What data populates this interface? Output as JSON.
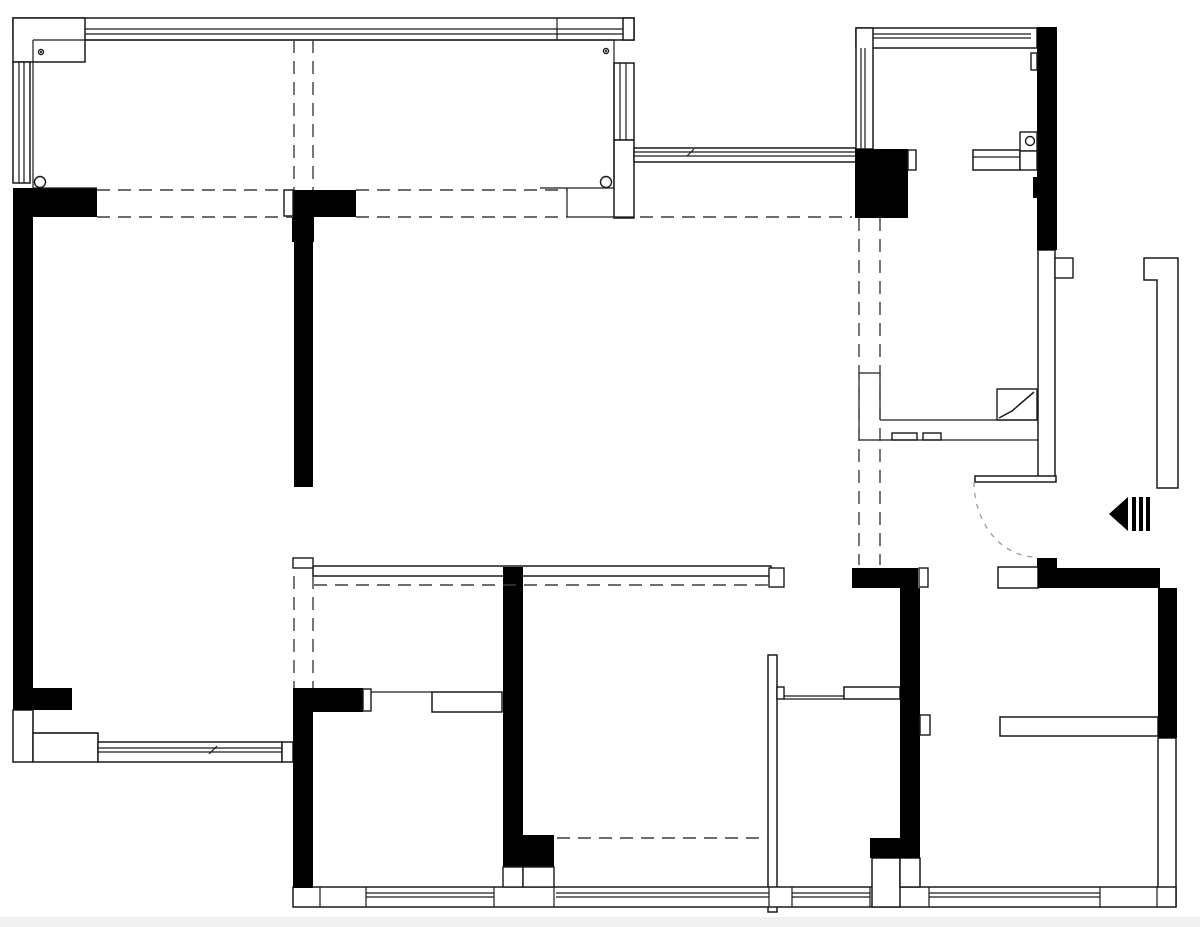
{
  "meta": {
    "drawing_kind": "apartment-floor-plan",
    "canvas": {
      "width": 1200,
      "height": 927
    },
    "colors": {
      "wall_fill": "#000000",
      "line": "#1a1a1a",
      "outline_fill": "#ffffff",
      "dash": "#3d3d3d",
      "arc_dash": "#9a9a9a",
      "background": "#ffffff",
      "footer_strip": "#f3f1f0"
    }
  },
  "plan": {
    "outline_rects": [
      {
        "name": "balcony-top-wall-band",
        "x": 13,
        "y": 18,
        "w": 621,
        "h": 22
      },
      {
        "name": "balcony-top-left-corner-box",
        "x": 13,
        "y": 18,
        "w": 72,
        "h": 44
      },
      {
        "name": "balcony-top-right-corner-box",
        "x": 623,
        "y": 18,
        "w": 11,
        "h": 22
      },
      {
        "name": "balcony-left-window",
        "x": 13,
        "y": 62,
        "w": 17,
        "h": 121
      },
      {
        "name": "balcony-right-window",
        "x": 614,
        "y": 63,
        "w": 20,
        "h": 77
      },
      {
        "name": "balcony-right-wall-lower",
        "x": 614,
        "y": 140,
        "w": 20,
        "h": 78
      },
      {
        "name": "connector-window-band",
        "x": 634,
        "y": 148,
        "w": 222,
        "h": 14
      },
      {
        "name": "kitchen-top-wall-band",
        "x": 856,
        "y": 28,
        "w": 181,
        "h": 20
      },
      {
        "name": "kitchen-left-wall-band",
        "x": 856,
        "y": 28,
        "w": 17,
        "h": 121
      },
      {
        "name": "kitchen-counter",
        "x": 973,
        "y": 150,
        "w": 47,
        "h": 20
      },
      {
        "name": "entry-right-hollow-wall",
        "x": 1038,
        "y": 250,
        "w": 17,
        "h": 227
      },
      {
        "name": "entry-door-header-wall",
        "x": 975,
        "y": 476,
        "w": 81,
        "h": 6
      },
      {
        "name": "bedroom2-top-wall-band",
        "x": 313,
        "y": 566,
        "w": 458,
        "h": 10
      },
      {
        "name": "bedroom2-right-thin-wall",
        "x": 768,
        "y": 655,
        "w": 9,
        "h": 257
      },
      {
        "name": "corridor-wall-bar",
        "x": 844,
        "y": 687,
        "w": 56,
        "h": 12
      },
      {
        "name": "bedroom1-door-wall-bar",
        "x": 432,
        "y": 692,
        "w": 70,
        "h": 20
      },
      {
        "name": "bedroom3-right-hollow-wall",
        "x": 1158,
        "y": 738,
        "w": 18,
        "h": 168
      },
      {
        "name": "bedroom3-wardrobe",
        "x": 1000,
        "y": 717,
        "w": 158,
        "h": 19
      },
      {
        "name": "bedroom3-window-box",
        "x": 998,
        "y": 567,
        "w": 40,
        "h": 21
      },
      {
        "name": "livingroom-bottom-corner-block",
        "x": 13,
        "y": 710,
        "w": 20,
        "h": 52
      },
      {
        "name": "livingroom-bottom-corner-step",
        "x": 33,
        "y": 733,
        "w": 65,
        "h": 29
      },
      {
        "name": "livingroom-bottom-window",
        "x": 98,
        "y": 742,
        "w": 184,
        "h": 20
      },
      {
        "name": "livingroom-bottom-window-endbox",
        "x": 282,
        "y": 742,
        "w": 11,
        "h": 20
      },
      {
        "name": "bottom-outer-wall-band",
        "x": 293,
        "y": 887,
        "w": 883,
        "h": 20
      },
      {
        "name": "hall-bottom-hollow-box",
        "x": 872,
        "y": 858,
        "w": 28,
        "h": 49
      },
      {
        "name": "hall-wall-hollow-stem",
        "x": 900,
        "y": 858,
        "w": 20,
        "h": 29
      }
    ],
    "solid_rects": [
      {
        "name": "livingroom-topleft-wall",
        "x": 13,
        "y": 188,
        "w": 84,
        "h": 29
      },
      {
        "name": "livingroom-left-wall",
        "x": 13,
        "y": 217,
        "w": 20,
        "h": 471
      },
      {
        "name": "livingroom-left-wall-cap",
        "x": 13,
        "y": 688,
        "w": 59,
        "h": 22
      },
      {
        "name": "mid-wall-t-bar",
        "x": 293,
        "y": 190,
        "w": 63,
        "h": 27
      },
      {
        "name": "mid-wall-stem-upper",
        "x": 292,
        "y": 217,
        "w": 22,
        "h": 25
      },
      {
        "name": "mid-wall-stem",
        "x": 294,
        "y": 242,
        "w": 19,
        "h": 245
      },
      {
        "name": "kitchen-flue-block",
        "x": 855,
        "y": 149,
        "w": 53,
        "h": 69
      },
      {
        "name": "kitchen-right-wall",
        "x": 1037,
        "y": 27,
        "w": 20,
        "h": 223
      },
      {
        "name": "kitchen-right-wall-step",
        "x": 1033,
        "y": 177,
        "w": 4,
        "h": 21
      },
      {
        "name": "entry-wall-stub",
        "x": 1037,
        "y": 558,
        "w": 20,
        "h": 10
      },
      {
        "name": "bedroom3-top-wall",
        "x": 1038,
        "y": 568,
        "w": 122,
        "h": 20
      },
      {
        "name": "bedroom3-right-wall",
        "x": 1158,
        "y": 588,
        "w": 19,
        "h": 150
      },
      {
        "name": "hall-wall-cap",
        "x": 852,
        "y": 568,
        "w": 66,
        "h": 20
      },
      {
        "name": "hall-left-wall",
        "x": 900,
        "y": 588,
        "w": 20,
        "h": 270
      },
      {
        "name": "hall-wall-foot",
        "x": 870,
        "y": 838,
        "w": 50,
        "h": 20
      },
      {
        "name": "bedroom1-left-wall",
        "x": 293,
        "y": 688,
        "w": 20,
        "h": 200
      },
      {
        "name": "bedroom1-top-wall",
        "x": 293,
        "y": 688,
        "w": 70,
        "h": 24
      },
      {
        "name": "bedroom-divider-wall",
        "x": 503,
        "y": 567,
        "w": 20,
        "h": 296
      },
      {
        "name": "bedroom-divider-foot",
        "x": 503,
        "y": 835,
        "w": 51,
        "h": 32
      },
      {
        "name": "entry-arrow-bar-1",
        "x": 1132,
        "y": 497,
        "w": 4,
        "h": 34
      },
      {
        "name": "entry-arrow-bar-2",
        "x": 1139,
        "y": 497,
        "w": 4,
        "h": 34
      },
      {
        "name": "entry-arrow-bar-3",
        "x": 1146,
        "y": 497,
        "w": 4,
        "h": 34
      }
    ],
    "boxes": [
      {
        "name": "kitchen-wall-switch-box",
        "x": 1031,
        "y": 53,
        "w": 6,
        "h": 17
      },
      {
        "name": "kitchen-sink-cabinet-upper",
        "x": 1020,
        "y": 132,
        "w": 17,
        "h": 19
      },
      {
        "name": "kitchen-sink-cabinet-lower",
        "x": 1020,
        "y": 151,
        "w": 17,
        "h": 19
      },
      {
        "name": "kitchen-flue-notch-box",
        "x": 908,
        "y": 150,
        "w": 8,
        "h": 20
      },
      {
        "name": "entry-wall-notch-box",
        "x": 1055,
        "y": 258,
        "w": 18,
        "h": 20
      },
      {
        "name": "mid-wall-white-box",
        "x": 284,
        "y": 190,
        "w": 9,
        "h": 26
      },
      {
        "name": "hall-cap-white-box",
        "x": 919,
        "y": 568,
        "w": 9,
        "h": 19
      },
      {
        "name": "hall-door-stop-box",
        "x": 920,
        "y": 715,
        "w": 10,
        "h": 20
      },
      {
        "name": "bedroom2-band-left-step",
        "x": 293,
        "y": 558,
        "w": 20,
        "h": 10
      },
      {
        "name": "bedroom2-band-right-jamb",
        "x": 769,
        "y": 568,
        "w": 15,
        "h": 19
      },
      {
        "name": "bedroom2-wall-hinge-box",
        "x": 777,
        "y": 687,
        "w": 7,
        "h": 12
      },
      {
        "name": "bedroom1-door-jamb-box",
        "x": 363,
        "y": 689,
        "w": 8,
        "h": 22
      },
      {
        "name": "divider-bottom-box-left",
        "x": 503,
        "y": 867,
        "w": 20,
        "h": 20
      },
      {
        "name": "divider-bottom-box-right",
        "x": 523,
        "y": 867,
        "w": 31,
        "h": 20
      },
      {
        "name": "bathroom-track-box-1",
        "x": 892,
        "y": 433,
        "w": 25,
        "h": 7
      },
      {
        "name": "bathroom-track-box-2",
        "x": 923,
        "y": 433,
        "w": 18,
        "h": 7
      },
      {
        "name": "bathroom-door-leaf",
        "x": 997,
        "y": 389,
        "w": 40,
        "h": 31
      }
    ],
    "lines": [
      {
        "name": "balcony-platform-left-edge",
        "x1": 33,
        "y1": 40,
        "x2": 33,
        "y2": 188
      },
      {
        "name": "balcony-platform-top-edge",
        "x1": 33,
        "y1": 40,
        "x2": 614,
        "y2": 40
      },
      {
        "name": "balcony-platform-right-edge",
        "x1": 614,
        "y1": 40,
        "x2": 614,
        "y2": 188
      },
      {
        "name": "balcony-platform-bottom-left",
        "x1": 33,
        "y1": 188,
        "x2": 97,
        "y2": 188
      },
      {
        "name": "balcony-platform-bottom-right",
        "x1": 540,
        "y1": 188,
        "x2": 614,
        "y2": 188
      },
      {
        "name": "balcony-step-vertical",
        "x1": 567,
        "y1": 188,
        "x2": 567,
        "y2": 217
      },
      {
        "name": "balcony-step-horizontal",
        "x1": 567,
        "y1": 217,
        "x2": 634,
        "y2": 217
      },
      {
        "name": "balcony-band-mullion",
        "x1": 557,
        "y1": 18,
        "x2": 557,
        "y2": 40
      },
      {
        "name": "balcony-band-glaze-1",
        "x1": 85,
        "y1": 29,
        "x2": 623,
        "y2": 29
      },
      {
        "name": "balcony-band-glaze-2",
        "x1": 85,
        "y1": 34,
        "x2": 623,
        "y2": 34
      },
      {
        "name": "balcony-leftwin-glaze-1",
        "x1": 19,
        "y1": 62,
        "x2": 19,
        "y2": 183
      },
      {
        "name": "balcony-leftwin-glaze-2",
        "x1": 24,
        "y1": 62,
        "x2": 24,
        "y2": 183
      },
      {
        "name": "balcony-rightwin-glaze-1",
        "x1": 620,
        "y1": 63,
        "x2": 620,
        "y2": 140
      },
      {
        "name": "balcony-rightwin-glaze-2",
        "x1": 626,
        "y1": 63,
        "x2": 626,
        "y2": 140
      },
      {
        "name": "connector-glaze-1",
        "x1": 634,
        "y1": 152,
        "x2": 856,
        "y2": 152
      },
      {
        "name": "connector-glaze-2",
        "x1": 634,
        "y1": 156,
        "x2": 856,
        "y2": 156
      },
      {
        "name": "kitchen-band-glaze-1",
        "x1": 873,
        "y1": 34,
        "x2": 1031,
        "y2": 34
      },
      {
        "name": "kitchen-band-glaze-2",
        "x1": 873,
        "y1": 38,
        "x2": 1031,
        "y2": 38
      },
      {
        "name": "kitchen-leftband-glaze-1",
        "x1": 861,
        "y1": 48,
        "x2": 861,
        "y2": 149
      },
      {
        "name": "kitchen-leftband-glaze-2",
        "x1": 865,
        "y1": 48,
        "x2": 865,
        "y2": 149
      },
      {
        "name": "kitchen-counter-midline",
        "x1": 973,
        "y1": 157,
        "x2": 1020,
        "y2": 157
      },
      {
        "name": "bathroom-left-wall-top",
        "x1": 859,
        "y1": 373,
        "x2": 880,
        "y2": 373
      },
      {
        "name": "bathroom-left-wall-outer",
        "x1": 859,
        "y1": 373,
        "x2": 859,
        "y2": 440
      },
      {
        "name": "bathroom-left-wall-inner",
        "x1": 880,
        "y1": 373,
        "x2": 880,
        "y2": 420
      },
      {
        "name": "bathroom-inner-bottom-line",
        "x1": 880,
        "y1": 420,
        "x2": 1037,
        "y2": 420
      },
      {
        "name": "bathroom-outer-bottom-line",
        "x1": 859,
        "y1": 440,
        "x2": 1038,
        "y2": 440
      },
      {
        "name": "bedroom1-door-header",
        "x1": 371,
        "y1": 692,
        "x2": 432,
        "y2": 692
      },
      {
        "name": "corridor-opening-line-1",
        "x1": 784,
        "y1": 696,
        "x2": 844,
        "y2": 696
      },
      {
        "name": "corridor-opening-line-2",
        "x1": 784,
        "y1": 699,
        "x2": 844,
        "y2": 699
      },
      {
        "name": "lr-window-glaze-1",
        "x1": 98,
        "y1": 748,
        "x2": 282,
        "y2": 748
      },
      {
        "name": "lr-window-glaze-2",
        "x1": 98,
        "y1": 752,
        "x2": 282,
        "y2": 752
      },
      {
        "name": "lr-corner-inner-v",
        "x1": 33,
        "y1": 710,
        "x2": 33,
        "y2": 733
      },
      {
        "name": "lr-corner-inner-h",
        "x1": 33,
        "y1": 733,
        "x2": 98,
        "y2": 733
      },
      {
        "name": "lr-corner-inner-v2",
        "x1": 98,
        "y1": 733,
        "x2": 98,
        "y2": 742
      },
      {
        "name": "bottomwin1-glaze-1",
        "x1": 366,
        "y1": 893,
        "x2": 494,
        "y2": 893
      },
      {
        "name": "bottomwin1-glaze-2",
        "x1": 366,
        "y1": 897,
        "x2": 494,
        "y2": 897
      },
      {
        "name": "bottomwin2-glaze-1",
        "x1": 556,
        "y1": 893,
        "x2": 769,
        "y2": 893
      },
      {
        "name": "bottomwin2-glaze-2",
        "x1": 556,
        "y1": 897,
        "x2": 769,
        "y2": 897
      },
      {
        "name": "bottomwin3-glaze-1",
        "x1": 792,
        "y1": 893,
        "x2": 870,
        "y2": 893
      },
      {
        "name": "bottomwin3-glaze-2",
        "x1": 792,
        "y1": 897,
        "x2": 870,
        "y2": 897
      },
      {
        "name": "bottomwin4-glaze-1",
        "x1": 929,
        "y1": 893,
        "x2": 1100,
        "y2": 893
      },
      {
        "name": "bottomwin4-glaze-2",
        "x1": 929,
        "y1": 897,
        "x2": 1100,
        "y2": 897
      },
      {
        "name": "band-divider-a",
        "x1": 320,
        "y1": 887,
        "x2": 320,
        "y2": 907
      },
      {
        "name": "band-divider-b",
        "x1": 366,
        "y1": 887,
        "x2": 366,
        "y2": 907
      },
      {
        "name": "band-divider-c",
        "x1": 494,
        "y1": 887,
        "x2": 494,
        "y2": 907
      },
      {
        "name": "band-divider-d",
        "x1": 554,
        "y1": 887,
        "x2": 554,
        "y2": 907
      },
      {
        "name": "band-divider-e",
        "x1": 769,
        "y1": 887,
        "x2": 769,
        "y2": 907
      },
      {
        "name": "band-divider-f",
        "x1": 792,
        "y1": 887,
        "x2": 792,
        "y2": 907
      },
      {
        "name": "band-divider-g",
        "x1": 870,
        "y1": 887,
        "x2": 870,
        "y2": 907
      },
      {
        "name": "band-divider-h",
        "x1": 929,
        "y1": 887,
        "x2": 929,
        "y2": 907
      },
      {
        "name": "band-divider-i",
        "x1": 1100,
        "y1": 887,
        "x2": 1100,
        "y2": 907
      },
      {
        "name": "band-divider-j",
        "x1": 1157,
        "y1": 887,
        "x2": 1157,
        "y2": 907
      },
      {
        "name": "window-break-tick-1",
        "x1": 209,
        "y1": 754,
        "x2": 217,
        "y2": 746
      },
      {
        "name": "window-break-tick-2",
        "x1": 687,
        "y1": 156,
        "x2": 694,
        "y2": 149
      }
    ],
    "dashed_lines": [
      {
        "name": "ceiling-dash-top-1",
        "x1": 97,
        "y1": 190,
        "x2": 293,
        "y2": 190
      },
      {
        "name": "ceiling-dash-top-2",
        "x1": 356,
        "y1": 190,
        "x2": 567,
        "y2": 190
      },
      {
        "name": "ceiling-dash-bottom-1",
        "x1": 97,
        "y1": 217,
        "x2": 292,
        "y2": 217
      },
      {
        "name": "ceiling-dash-bottom-2",
        "x1": 356,
        "y1": 217,
        "x2": 567,
        "y2": 217
      },
      {
        "name": "ceiling-dash-right",
        "x1": 640,
        "y1": 217,
        "x2": 852,
        "y2": 217
      },
      {
        "name": "balcony-dash-vert-1",
        "x1": 294,
        "y1": 40,
        "x2": 294,
        "y2": 190
      },
      {
        "name": "balcony-dash-vert-2",
        "x1": 313,
        "y1": 40,
        "x2": 313,
        "y2": 190
      },
      {
        "name": "corridor-dash-vert-1",
        "x1": 859,
        "y1": 218,
        "x2": 859,
        "y2": 565
      },
      {
        "name": "corridor-dash-vert-2",
        "x1": 880,
        "y1": 218,
        "x2": 880,
        "y2": 565
      },
      {
        "name": "bedroom-dash-vert-1",
        "x1": 294,
        "y1": 576,
        "x2": 294,
        "y2": 688
      },
      {
        "name": "bedroom-dash-vert-2",
        "x1": 313,
        "y1": 576,
        "x2": 313,
        "y2": 688
      },
      {
        "name": "bedroom2-ceiling-dash",
        "x1": 314,
        "y1": 585,
        "x2": 768,
        "y2": 585
      },
      {
        "name": "bedroom2-bottom-dash",
        "x1": 557,
        "y1": 838,
        "x2": 768,
        "y2": 838
      }
    ],
    "circles": [
      {
        "name": "balcony-screw-topleft",
        "cx": 41,
        "cy": 52,
        "r": 2.5,
        "dot": true
      },
      {
        "name": "balcony-screw-topright",
        "cx": 606,
        "cy": 51,
        "r": 2.5,
        "dot": true
      },
      {
        "name": "balcony-post-bottomleft",
        "cx": 40,
        "cy": 182,
        "r": 5.5,
        "dot": false
      },
      {
        "name": "balcony-post-bottomright",
        "cx": 606,
        "cy": 182,
        "r": 5.5,
        "dot": false
      },
      {
        "name": "kitchen-sink-drain",
        "cx": 1030,
        "cy": 141,
        "r": 4.5,
        "dot": false
      }
    ],
    "polygons": [
      {
        "name": "entry-jamb-l-bar",
        "points": "1144,258 1178,258 1178,488 1157,488 1157,280 1144,280",
        "fill": "white"
      },
      {
        "name": "entry-arrow-triangle-icon",
        "points": "1128,497 1128,531 1109,514",
        "fill": "black"
      }
    ],
    "polylines": [
      {
        "name": "bathroom-door-fold-line",
        "points": "999,418 1012,411 1034,392"
      }
    ],
    "arcs": [
      {
        "name": "entry-door-swing-arc",
        "d": "M 974 482 A 62 75 0 0 0 1036 557"
      }
    ]
  }
}
